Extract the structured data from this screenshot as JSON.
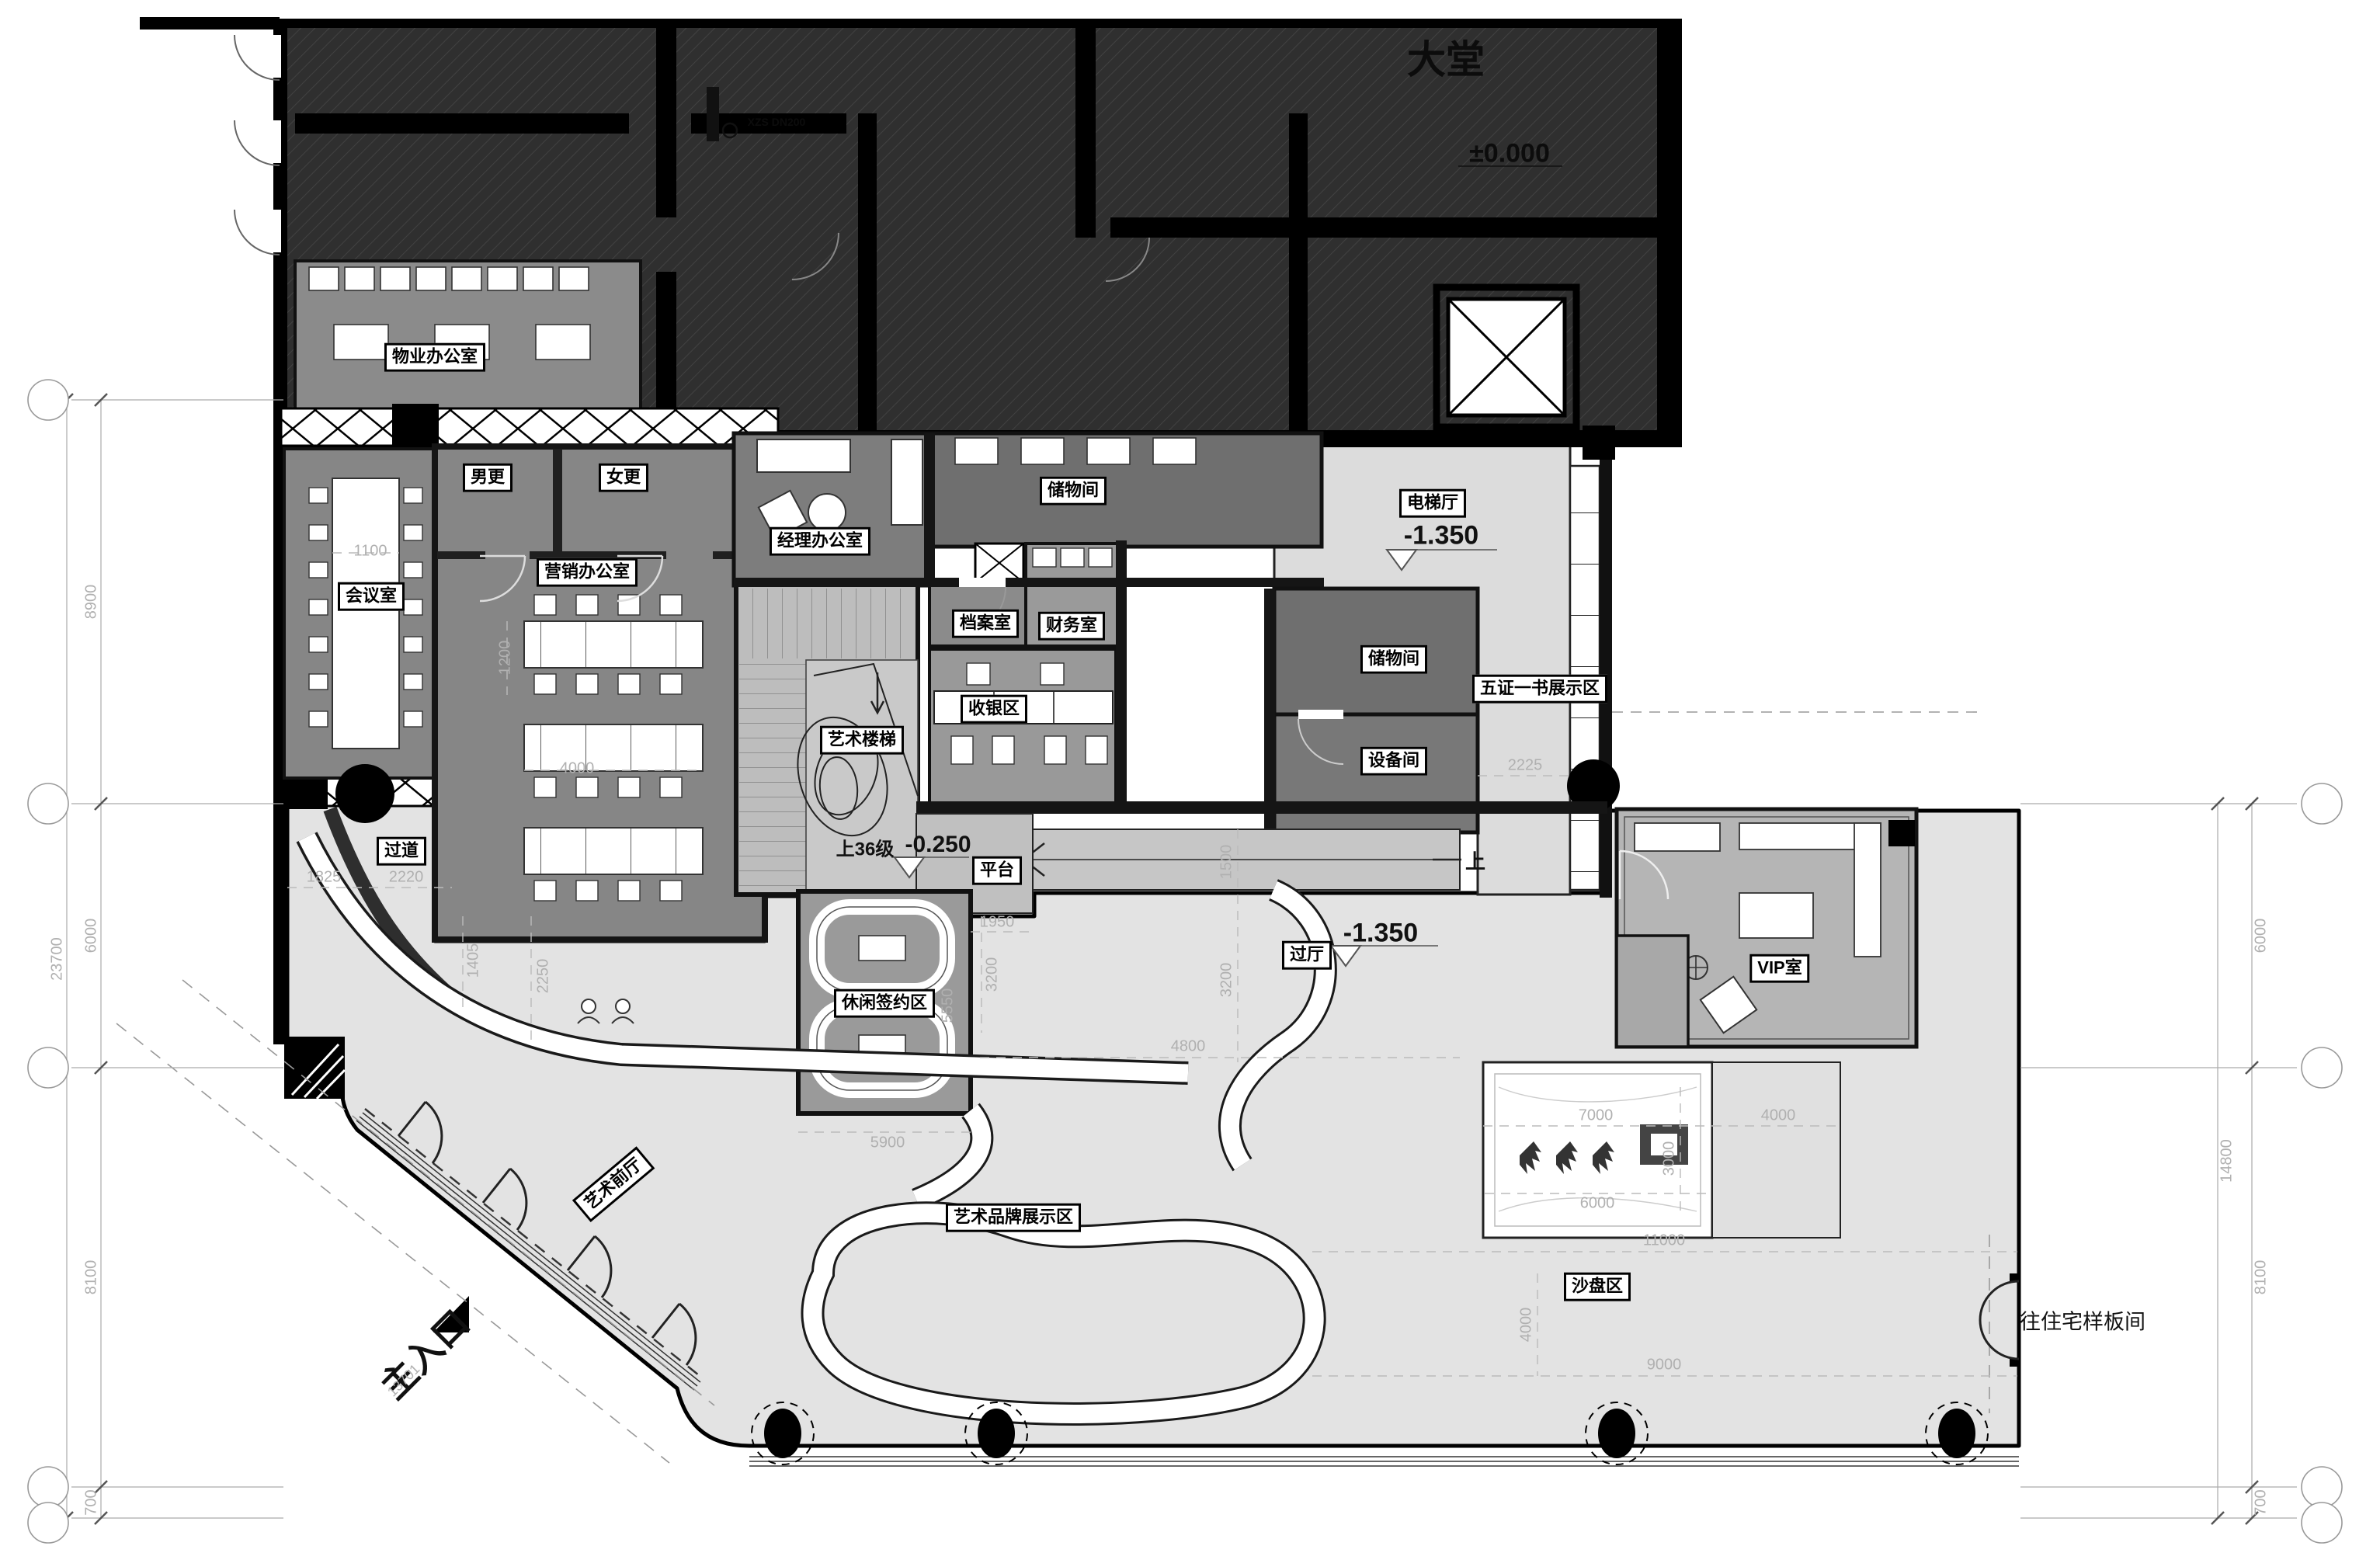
{
  "labels": {
    "datang": "大堂",
    "wuye": "物业办公室",
    "nangeng": "男更",
    "nvgeng": "女更",
    "huiyishi": "会议室",
    "yingxiao": "营销办公室",
    "jingli": "经理办公室",
    "chuwujian": "储物间",
    "chuwujian2": "储物间",
    "dangan": "档案室",
    "caiwu": "财务室",
    "shouyin": "收银区",
    "yishulouti": "艺术楼梯",
    "shang36": "上36级",
    "dianti": "电梯厅",
    "shebei": "设备间",
    "wuzheng": "五证一书展示区",
    "guodao": "过道",
    "pingtai": "平台",
    "guoting": "过厅",
    "xiuxian": "休闲签约区",
    "vip": "VIP室",
    "yishuqianting": "艺术前厅",
    "yishupinpai": "艺术品牌展示区",
    "shapan": "沙盘区",
    "zhurukou": "主入口",
    "wangzhuzhai": "往住宅样板间",
    "shang": "上",
    "xzs": "XZS  DN200"
  },
  "elevations": {
    "zero": "±0.000",
    "minus1350": "-1.350",
    "minus0250": "-0.250"
  },
  "dims": {
    "v8900": "8900",
    "v6000": "6000",
    "v8100": "8100",
    "v700": "700",
    "v23700": "23700",
    "v14800": "14800",
    "v1100": "1100",
    "v1200": "1200",
    "v4000": "4000",
    "v1825": "1825",
    "v2220": "2220",
    "v1405": "1405",
    "v2250": "2250",
    "v1950": "1950",
    "v3200": "3200",
    "v5550": "5550",
    "v1500": "1500",
    "v4800": "4800",
    "v5900": "5900",
    "v2225": "2225",
    "v7000": "7000",
    "v3000": "3000",
    "v11000": "11000",
    "v9000": "9000",
    "v13701": "13701"
  },
  "colors": {
    "existing_hatch": "#2f2f2f",
    "room_mid_gray": "#868686",
    "room_dark_gray": "#6f6f6f",
    "floor_light": "#e3e3e3",
    "hall_light": "#dcdcdc",
    "stair_gray": "#bdbdbd",
    "wall_black": "#000000"
  }
}
